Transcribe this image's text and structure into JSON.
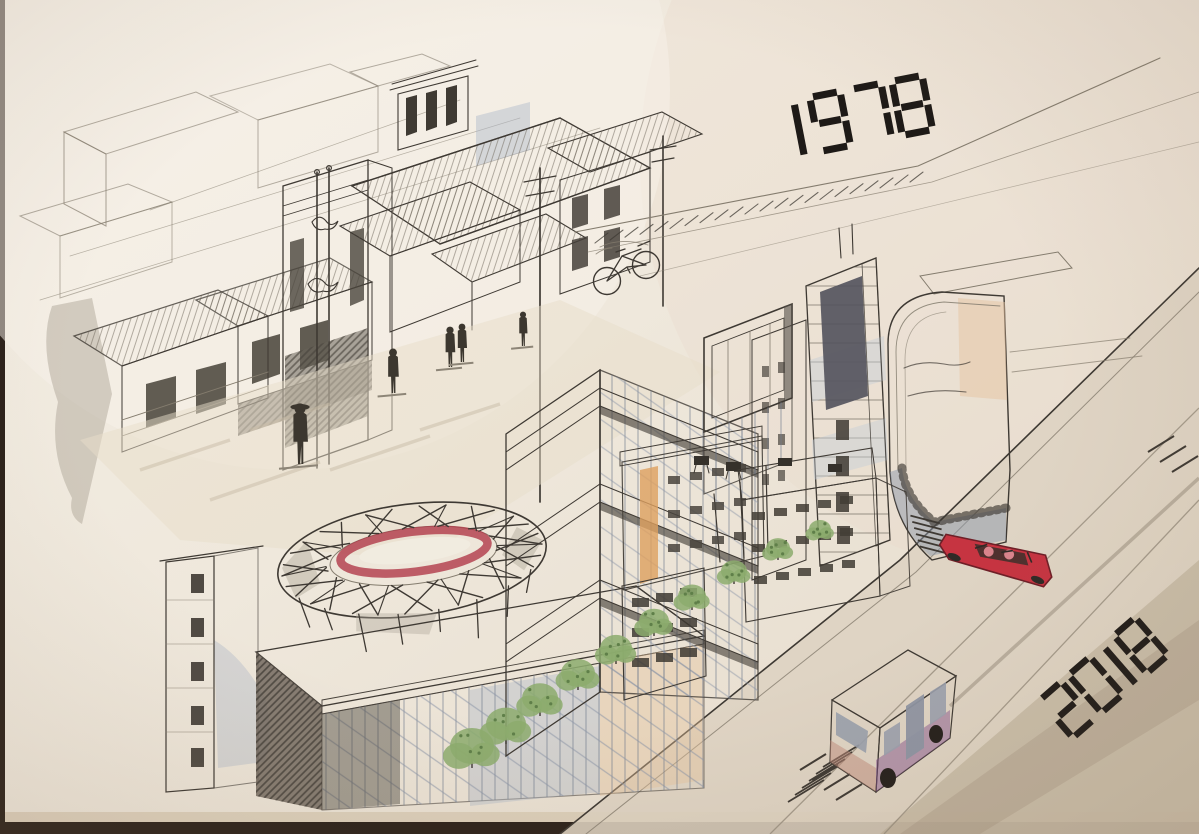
{
  "meta": {
    "title": "Watercolor and ink sketch comparing a 1978 old town street with a 2018 modern city district",
    "medium": "pen and ink with watercolor on paper",
    "subject": "urban development comparison, Beijing"
  },
  "era": {
    "old": "1978",
    "new": "2018"
  },
  "palette": {
    "photo_backdrop": "#2b211a",
    "paper": "#efe8dc",
    "paper_shade": "#e3d8c9",
    "paper_warm": "#e8d6c8",
    "paper_edge": "#d8cab4",
    "ink": "#3e3933",
    "ink_light": "#847c6e",
    "marker_black": "#1e1a17",
    "wash_beige": "#ddd0b8",
    "wash_tan": "#cbbda4",
    "wash_gray": "#b0a89a",
    "wash_bluegray": "#aeb9c9",
    "wash_slate": "#8c97a9",
    "wash_glass": "#b9c3d4",
    "accent_cream": "#ece3bd",
    "accent_yellowgreen": "#d3d67e",
    "accent_yellow": "#e9cb74",
    "accent_orange": "#dda05f",
    "accent_red": "#c63441",
    "accent_crimson": "#b03a48",
    "accent_purple": "#a263ae",
    "accent_purple_dark": "#7e4a8a",
    "accent_green": "#8cab6d",
    "green_dark": "#5f7f49",
    "road": "#ded3c2",
    "road_shadow": "#b5a790"
  },
  "scene": {
    "old_city": {
      "era_label": "1978",
      "elements": [
        "abstract box rooftops",
        "two-story shop houses",
        "corrugated metal roofs",
        "ornate gate facade with crest ornaments",
        "courtyard mansion with clerestory tower",
        "utility poles with crossarms",
        "bicycle line sketch",
        "pedestrians (one wearing a hat, one pair)",
        "street shadow washes",
        "hatched road edge band"
      ]
    },
    "new_city": {
      "era_label": "2018",
      "elements": [
        "birds-nest stadium with red ring",
        "angular glass tower with cream zig-zag bands",
        "floor-slab high-rise with yellow-green stripe",
        "cantilevered glass box",
        "curved corner tower with balcony band",
        "yellow apartment blocks with rooftop units",
        "orange apartment block",
        "glass exhibition hall",
        "residential slab tower with window column",
        "street trees",
        "red convertible with passengers and speed hatching",
        "purple city bus with white roof",
        "diagonal boulevard with lane lines"
      ]
    }
  }
}
